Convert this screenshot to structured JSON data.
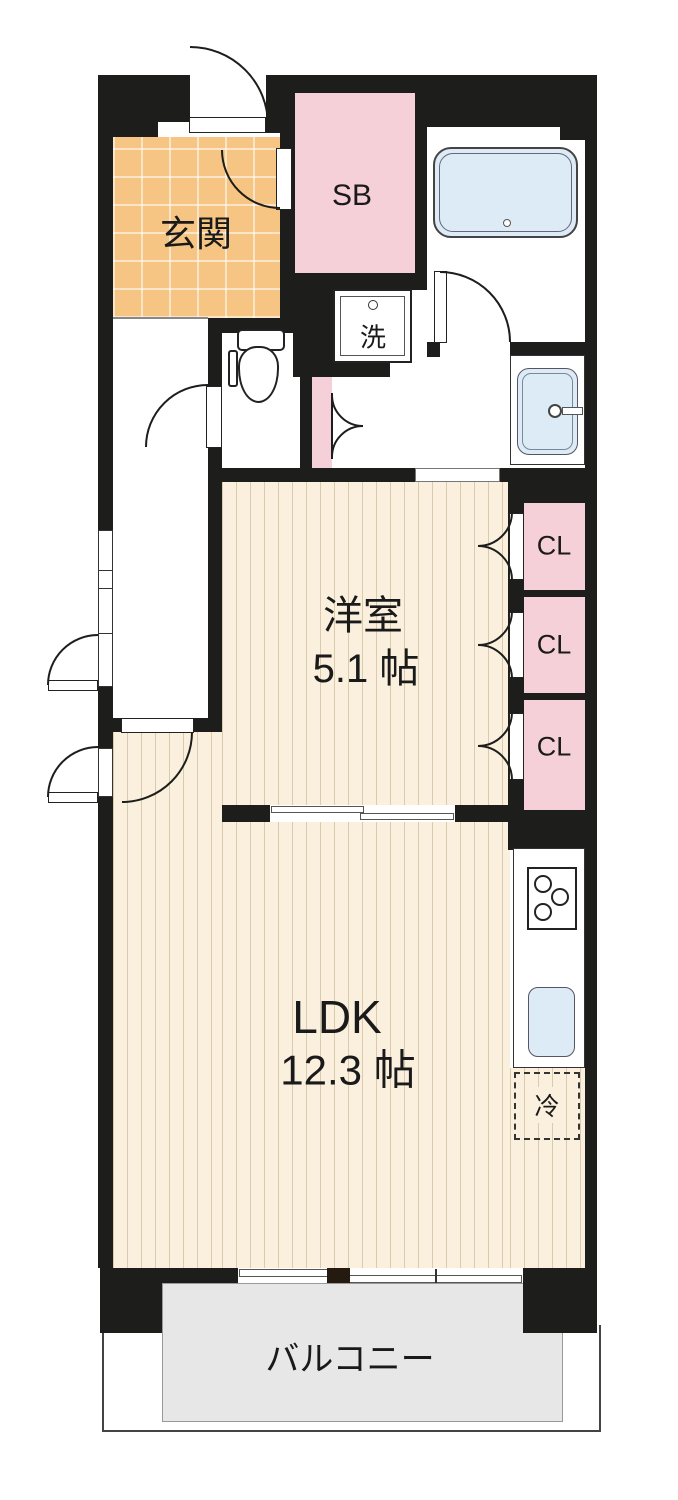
{
  "rooms": {
    "genkan": {
      "label": "玄関"
    },
    "shoebox": {
      "label": "SB"
    },
    "laundry": {
      "label": "洗"
    },
    "western": {
      "label": "洋室",
      "size": "5.1 帖"
    },
    "closet": {
      "label": "CL"
    },
    "ldk": {
      "label": "LDK",
      "size": "12.3 帖"
    },
    "fridge": {
      "label": "冷"
    },
    "balcony": {
      "label": "バルコニー"
    }
  },
  "colors": {
    "wall": "#1d1d1b",
    "entry_floor_orange": "#f6c583",
    "storage_pink": "#f6d0d8",
    "wood_floor_cream": "#faf0dd",
    "water_fixture_blue": "#dcebf5",
    "balcony_gray": "#e7e7e7"
  }
}
